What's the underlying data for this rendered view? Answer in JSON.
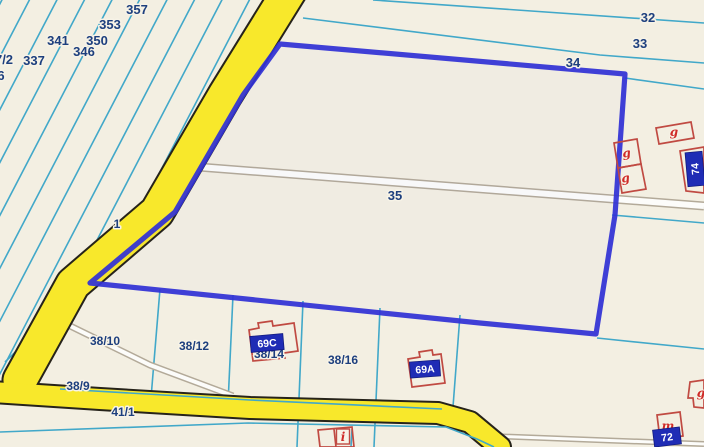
{
  "map": {
    "colors": {
      "background": "#f3efe2",
      "boundary_cyan": "#41a8c9",
      "parcel_label_navy": "#1d3f7e",
      "selection_blue": "#3232d6",
      "road_yellow": "#f8e82b",
      "road_outline": "#26231a",
      "building_red": "#c04a42",
      "building_letter_red": "#cf2b28",
      "address_plate_navy": "#1f2cb5",
      "path_white": "#fcfcfa",
      "path_border": "#b3aa99"
    },
    "selected_parcel": {
      "number": "35"
    },
    "parcel_labels": [
      {
        "text": "357",
        "x": 137,
        "y": 14
      },
      {
        "text": "353",
        "x": 110,
        "y": 29
      },
      {
        "text": "341",
        "x": 58,
        "y": 45
      },
      {
        "text": "350",
        "x": 97,
        "y": 45
      },
      {
        "text": "346",
        "x": 84,
        "y": 56
      },
      {
        "text": "337",
        "x": 34,
        "y": 65
      },
      {
        "text": "7/2",
        "x": 4,
        "y": 64
      },
      {
        "text": "6",
        "x": 1,
        "y": 80
      },
      {
        "text": "32",
        "x": 648,
        "y": 22
      },
      {
        "text": "33",
        "x": 640,
        "y": 48
      },
      {
        "text": "34",
        "x": 573,
        "y": 67
      },
      {
        "text": "35",
        "x": 395,
        "y": 200
      },
      {
        "text": "1",
        "x": 117,
        "y": 228,
        "small": true
      },
      {
        "text": "38/10",
        "x": 105,
        "y": 345,
        "small": true
      },
      {
        "text": "38/12",
        "x": 194,
        "y": 350,
        "small": true
      },
      {
        "text": "38/14",
        "x": 269,
        "y": 358,
        "small": true
      },
      {
        "text": "38/16",
        "x": 343,
        "y": 364,
        "small": true
      },
      {
        "text": "38/9",
        "x": 78,
        "y": 390,
        "small": true
      },
      {
        "text": "41/1",
        "x": 123,
        "y": 416,
        "small": true
      }
    ],
    "building_labels": [
      {
        "text": "g",
        "x": 674,
        "y": 136
      },
      {
        "text": "g",
        "x": 627,
        "y": 157,
        "rotate": -8
      },
      {
        "text": "g",
        "x": 626,
        "y": 182,
        "rotate": -8
      },
      {
        "text": "g",
        "x": 701,
        "y": 397
      },
      {
        "text": "m",
        "x": 668,
        "y": 430
      },
      {
        "text": "i",
        "x": 343,
        "y": 441,
        "boxed": true
      }
    ],
    "address_labels": [
      {
        "text": "69C",
        "x": 267,
        "y": 343,
        "w": 33,
        "h": 16,
        "rotate": -5
      },
      {
        "text": "69A",
        "x": 425,
        "y": 369,
        "w": 30,
        "h": 16,
        "rotate": -4
      },
      {
        "text": "72",
        "x": 667,
        "y": 437,
        "w": 27,
        "h": 17,
        "rotate": -7
      },
      {
        "text": "74",
        "x": 695,
        "y": 169,
        "w": 17,
        "h": 34,
        "rotate": -5,
        "text_rotate": -90
      }
    ]
  }
}
